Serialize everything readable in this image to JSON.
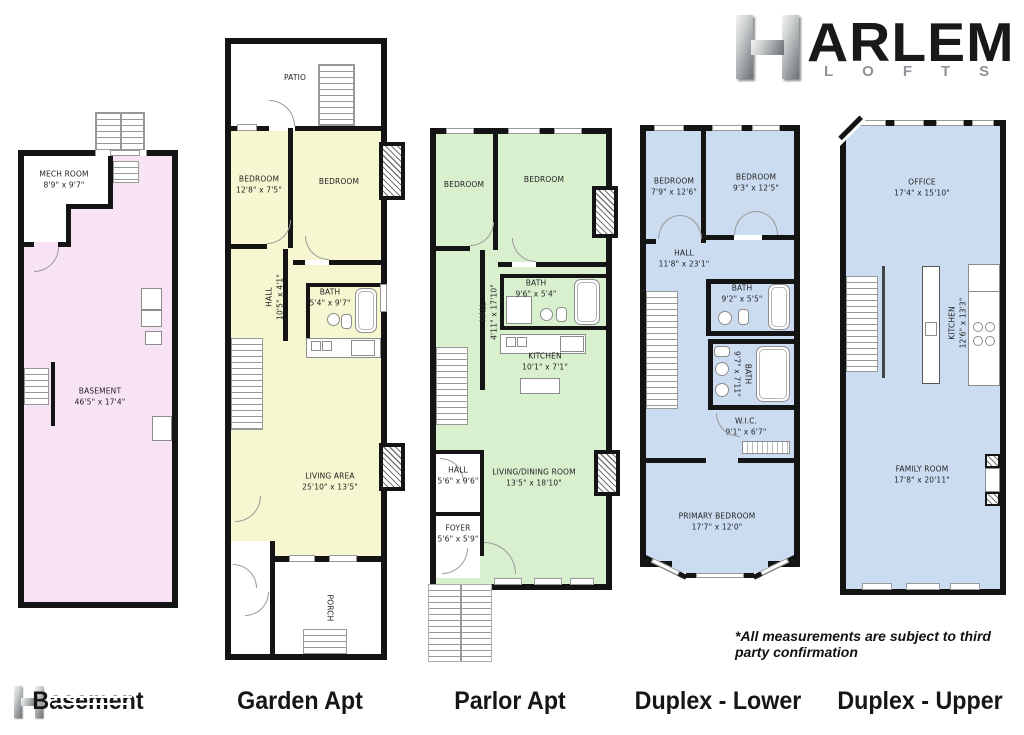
{
  "logo": {
    "h": "H",
    "name": "ARLEM",
    "sub": "LOFTS"
  },
  "disclaimer": "*All measurements are subject to third party confirmation",
  "colors": {
    "basement": "#f8e3f4",
    "garden": "#f6f6d0",
    "parlor": "#d9f0cf",
    "duplex": "#cbdcf1",
    "wall": "#141414"
  },
  "plans": [
    {
      "label": "Basement",
      "rooms": {
        "mech": {
          "name": "MECH ROOM",
          "dims": "8'9\" x 9'7\""
        },
        "basement": {
          "name": "BASEMENT",
          "dims": "46'5\" x 17'4\""
        }
      }
    },
    {
      "label": "Garden Apt",
      "rooms": {
        "patio": {
          "name": "PATIO"
        },
        "bedroom1": {
          "name": "BEDROOM",
          "dims": "12'8\" x 7'5\""
        },
        "bedroom2": {
          "name": "BEDROOM"
        },
        "hall": {
          "name": "HALL",
          "dims": "10'5\" x 4'1\""
        },
        "bath": {
          "name": "BATH",
          "dims": "5'4\" x 9'7\""
        },
        "living": {
          "name": "LIVING AREA",
          "dims": "25'10\" x 13'5\""
        },
        "porch": {
          "name": "PORCH"
        }
      }
    },
    {
      "label": "Parlor Apt",
      "rooms": {
        "bedroom1": {
          "name": "BEDROOM"
        },
        "bedroom2": {
          "name": "BEDROOM"
        },
        "bath": {
          "name": "BATH",
          "dims": "9'6\" x 5'4\""
        },
        "hall_upper": {
          "name": "HALL",
          "dims": "4'11\" x 17'10\""
        },
        "kitchen": {
          "name": "KITCHEN",
          "dims": "10'1\" x 7'1\""
        },
        "living": {
          "name": "LIVING/DINING ROOM",
          "dims": "13'5\" x 18'10\""
        },
        "hall_lower": {
          "name": "HALL",
          "dims": "5'6\" x 9'6\""
        },
        "foyer": {
          "name": "FOYER",
          "dims": "5'6\" x 5'9\""
        }
      }
    },
    {
      "label": "Duplex - Lower",
      "rooms": {
        "bedroom1": {
          "name": "BEDROOM",
          "dims": "7'9\" x 12'6\""
        },
        "bedroom2": {
          "name": "BEDROOM",
          "dims": "9'3\" x 12'5\""
        },
        "hall": {
          "name": "HALL",
          "dims": "11'8\" x 23'1\""
        },
        "bath1": {
          "name": "BATH",
          "dims": "9'2\" x 5'5\""
        },
        "bath2": {
          "name": "BATH",
          "dims": "9'7\" x 7'11\""
        },
        "wic": {
          "name": "W.I.C.",
          "dims": "9'1\" x 6'7\""
        },
        "primary": {
          "name": "PRIMARY BEDROOM",
          "dims": "17'7\" x 12'0\""
        }
      }
    },
    {
      "label": "Duplex - Upper",
      "rooms": {
        "office": {
          "name": "OFFICE",
          "dims": "17'4\" x 15'10\""
        },
        "kitchen": {
          "name": "KITCHEN",
          "dims": "12'6\" x 13'3\""
        },
        "family": {
          "name": "FAMILY ROOM",
          "dims": "17'8\" x 20'11\""
        }
      }
    }
  ]
}
